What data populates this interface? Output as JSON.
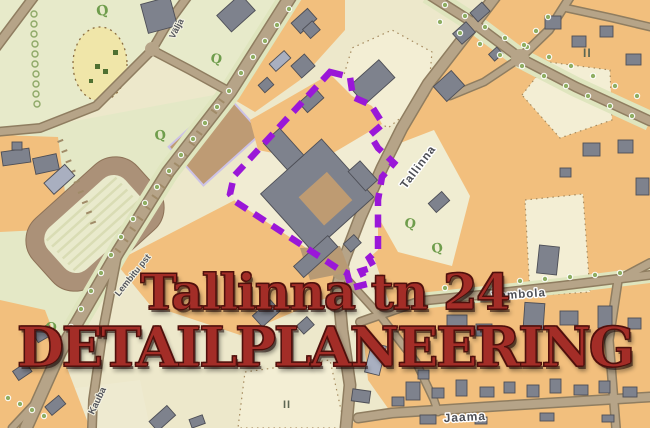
{
  "title_overlay": {
    "line1": "Tallinna tn 24",
    "line2": "DETAILPLANEERING",
    "color": "#a32d27"
  },
  "map": {
    "street_labels": [
      {
        "id": "valja",
        "text": "Välja"
      },
      {
        "id": "tallinna",
        "text": "Tallinna"
      },
      {
        "id": "lembitu",
        "text": "Lembitu pst"
      },
      {
        "id": "vambola",
        "text": "Vambola"
      },
      {
        "id": "kauba",
        "text": "Kauba"
      },
      {
        "id": "jaama",
        "text": "Jaama"
      }
    ],
    "parcel_labels": [
      {
        "text": "II"
      },
      {
        "text": "II"
      }
    ],
    "tree_symbol": "Q",
    "colors": {
      "block_orange": "#f2bf7d",
      "plot_cream": "#f3eed4",
      "park_green": "#e6e9c8",
      "meadow_yellow": "#f0e6a9",
      "road_fill": "#b6a488",
      "road_casing": "#8f7d60",
      "building_gray": "#7e828d",
      "building_light": "#a9afc0",
      "stadium_track": "#ab9178",
      "boundary_purple": "#9a17d8",
      "title_red": "#a32d27"
    }
  }
}
